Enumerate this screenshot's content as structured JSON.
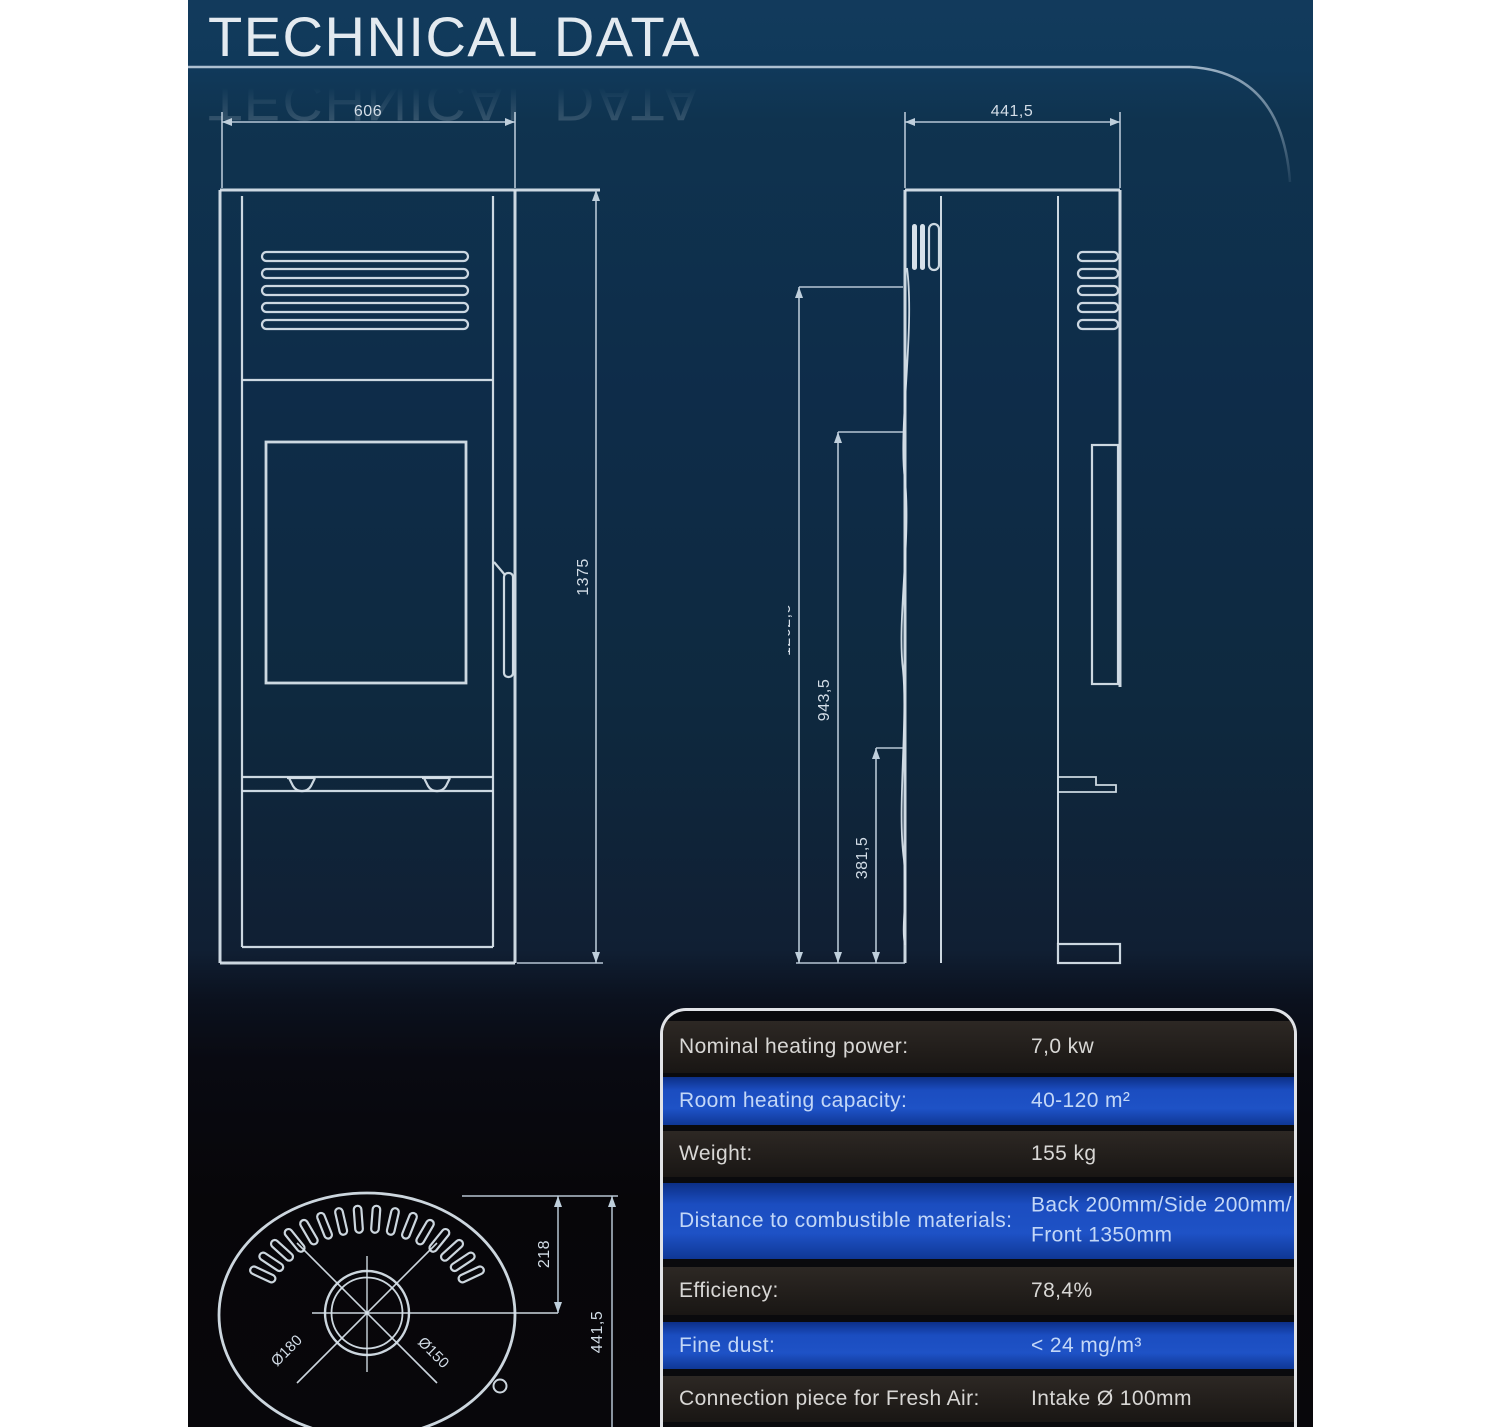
{
  "page": {
    "title": "TECHNICAL DATA"
  },
  "front_view": {
    "width_dim": "606",
    "height_dim": "1375"
  },
  "side_view": {
    "width_dim": "441,5",
    "upper_dim": "1202,5",
    "middle_dim": "943,5",
    "lower_dim": "381,5"
  },
  "top_view": {
    "flue_offset_dim": "218",
    "depth_dim": "441,5",
    "outer_diameter": "Ø180",
    "inner_diameter": "Ø150",
    "slot_count": 16
  },
  "spec_table": {
    "rows": [
      {
        "label": "Nominal heating power:",
        "value": "7,0 kw",
        "highlight": false
      },
      {
        "label": "Room heating capacity:",
        "value": "40-120 m²",
        "highlight": true
      },
      {
        "label": "Weight:",
        "value": "155 kg",
        "highlight": false
      },
      {
        "label": "Distance to combustible materials:",
        "value": "Back 200mm/Side 200mm/",
        "value2": "Front 1350mm",
        "highlight": true
      },
      {
        "label": "Efficiency:",
        "value": "78,4%",
        "highlight": false
      },
      {
        "label": "Fine dust:",
        "value": "< 24 mg/m³",
        "highlight": true
      },
      {
        "label": "Connection piece for Fresh Air:",
        "value": "Intake Ø 100mm",
        "highlight": false
      }
    ]
  },
  "colors": {
    "accent_blue": "#1b4dc0",
    "panel_navy": "#0e2c49",
    "line": "#d7e1ea"
  }
}
